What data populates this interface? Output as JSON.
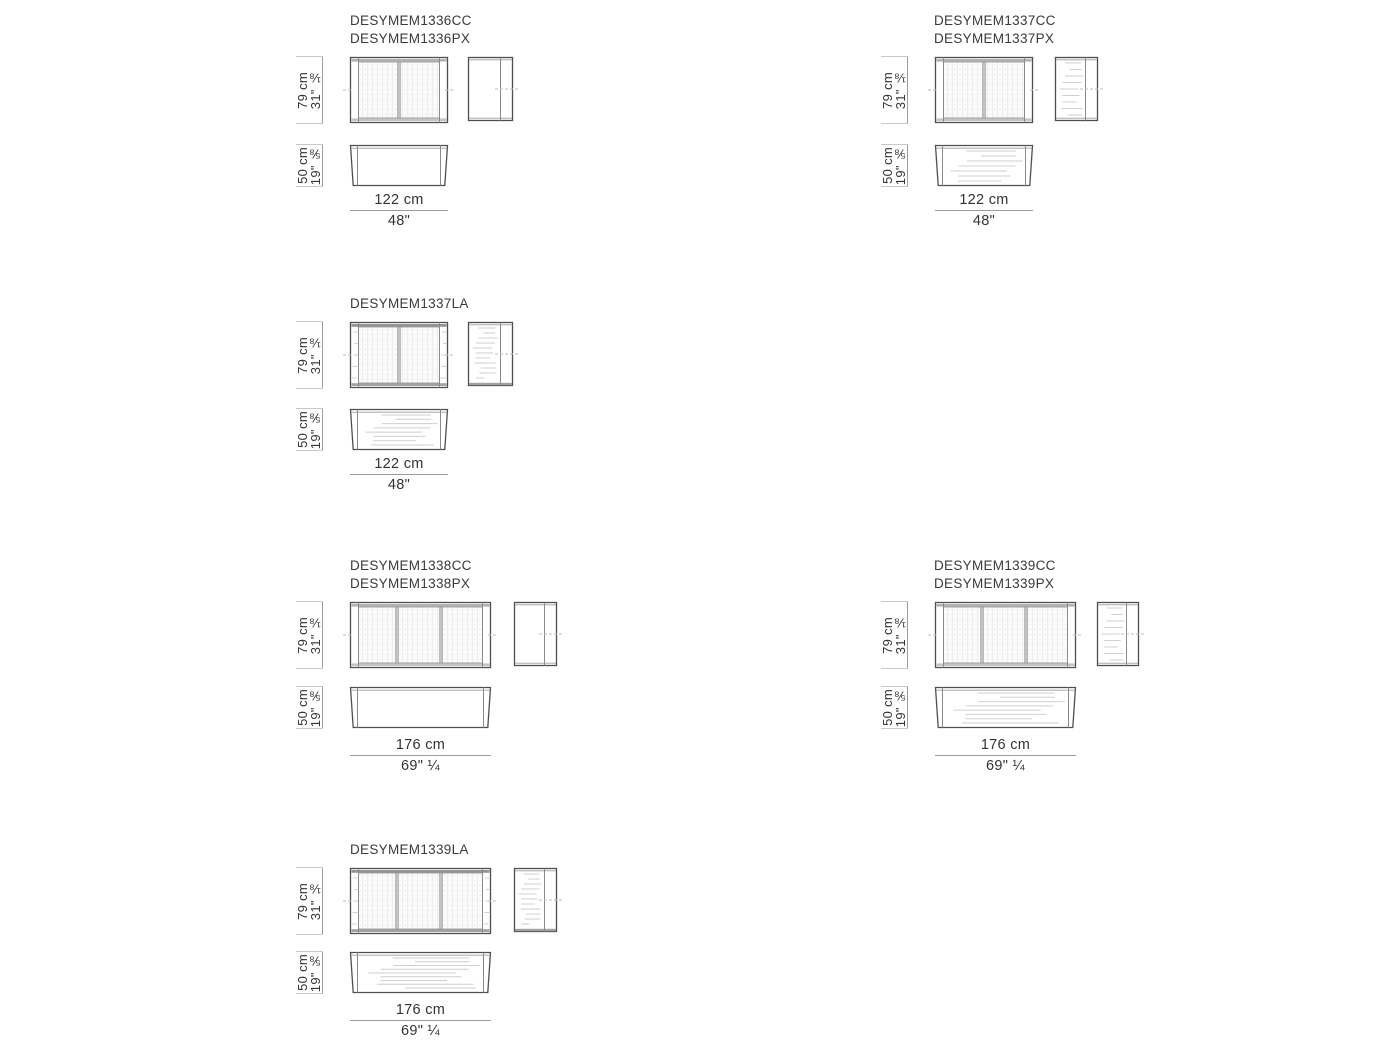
{
  "sheet": {
    "background": "#ffffff",
    "colors": {
      "outline": "#4f4f4f",
      "frame_line": "#8a8a8a",
      "rail_fill": "#b2b2b2",
      "dimension_line": "#9c9c9c",
      "tick": "#c8c8c8",
      "streak": "#cfcfcf",
      "text": "#333333"
    }
  },
  "blocks": [
    {
      "codes": [
        "DESYMEM1336CC",
        "DESYMEM1336PX"
      ],
      "height_cm": "79 cm",
      "height_in": "31\" ⅛",
      "depth_cm": "50 cm",
      "depth_in": "19\" ⅝",
      "width_cm": "122 cm",
      "width_in": "48\""
    },
    {
      "codes": [
        "DESYMEM1337CC",
        "DESYMEM1337PX"
      ],
      "height_cm": "79 cm",
      "height_in": "31\" ⅛",
      "depth_cm": "50 cm",
      "depth_in": "19\" ⅝",
      "width_cm": "122 cm",
      "width_in": "48\""
    },
    {
      "codes": [
        "DESYMEM1337LA"
      ],
      "height_cm": "79 cm",
      "height_in": "31\" ⅛",
      "depth_cm": "50 cm",
      "depth_in": "19\" ⅝",
      "width_cm": "122 cm",
      "width_in": "48\""
    },
    {
      "codes": [
        "DESYMEM1338CC",
        "DESYMEM1338PX"
      ],
      "height_cm": "79 cm",
      "height_in": "31\" ⅛",
      "depth_cm": "50 cm",
      "depth_in": "19\" ⅝",
      "width_cm": "176 cm",
      "width_in": "69\" ¼"
    },
    {
      "codes": [
        "DESYMEM1339CC",
        "DESYMEM1339PX"
      ],
      "height_cm": "79 cm",
      "height_in": "31\" ⅛",
      "depth_cm": "50 cm",
      "depth_in": "19\" ⅝",
      "width_cm": "176 cm",
      "width_in": "69\" ¼"
    },
    {
      "codes": [
        "DESYMEM1339LA"
      ],
      "height_cm": "79 cm",
      "height_in": "31\" ⅛",
      "depth_cm": "50 cm",
      "depth_in": "19\" ⅝",
      "width_cm": "176 cm",
      "width_in": "69\" ¼"
    }
  ]
}
